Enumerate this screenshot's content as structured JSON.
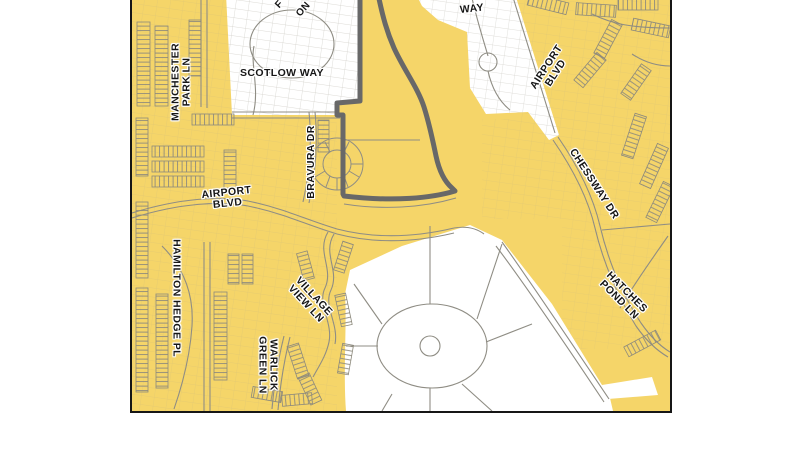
{
  "map": {
    "colors": {
      "highlight_yellow": "#F5D569",
      "subject_outline_gray": "#686868",
      "road_line_gray": "#8f8d84",
      "frame_black": "#161616",
      "background_white": "#ffffff"
    },
    "labels": {
      "manchester": {
        "line1": "MANCHESTER",
        "line2": "PARK LN"
      },
      "scotlow": {
        "text": "SCOTLOW WAY"
      },
      "fragment_f": {
        "text": "F"
      },
      "fragment_on": {
        "text": "ON"
      },
      "way": {
        "text": "WAY"
      },
      "airport_right": {
        "line1": "AIRPORT",
        "line2": "BLVD"
      },
      "chessway": {
        "text": "CHESSWAY DR"
      },
      "hatches": {
        "line1": "HATCHES",
        "line2": "POND LN"
      },
      "airport_left": {
        "line1": "AIRPORT",
        "line2": "BLVD"
      },
      "bravura": {
        "text": "BRAVURA DR"
      },
      "hamilton": {
        "text": "HAMILTON HEDGE PL"
      },
      "village": {
        "line1": "VILLAGE",
        "line2": "VIEW LN"
      },
      "warlick": {
        "line1": "WARLICK",
        "line2": "GREEN LN"
      }
    }
  }
}
